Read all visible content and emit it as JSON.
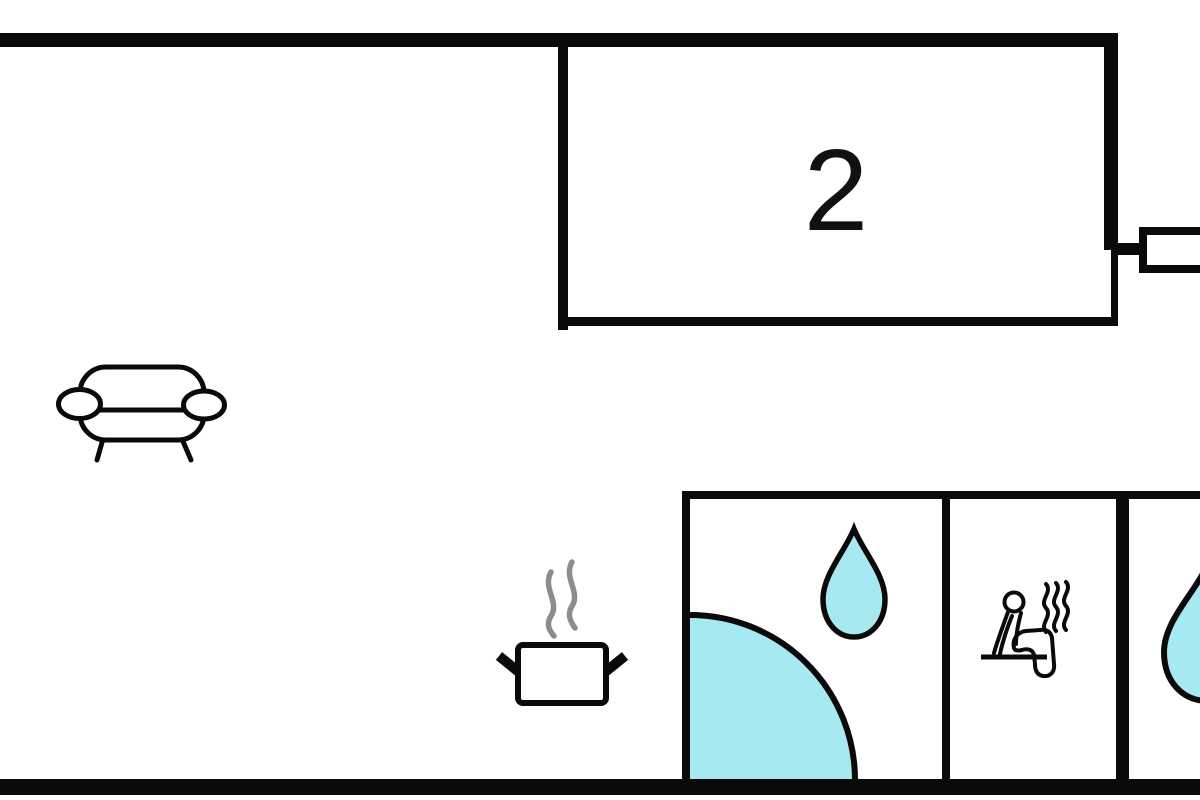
{
  "room": {
    "label": "2"
  },
  "colors": {
    "wall": "#0a0a0a",
    "water": "#a7e9f1",
    "steam": "#8c8c8c",
    "background": "#ffffff"
  },
  "icons": {
    "sofa": "sofa-icon",
    "cooking_pot": "cooking-pot-icon",
    "pot_steam": "steam-lines-icon",
    "shower_tray": "shower-tray-quarter-circle-icon",
    "shower_drop": "water-drop-icon",
    "sauna_person": "sauna-person-icon",
    "sauna_heat": "heat-waves-icon",
    "second_bath_drop": "water-drop-icon",
    "radiator": "radiator-icon"
  }
}
